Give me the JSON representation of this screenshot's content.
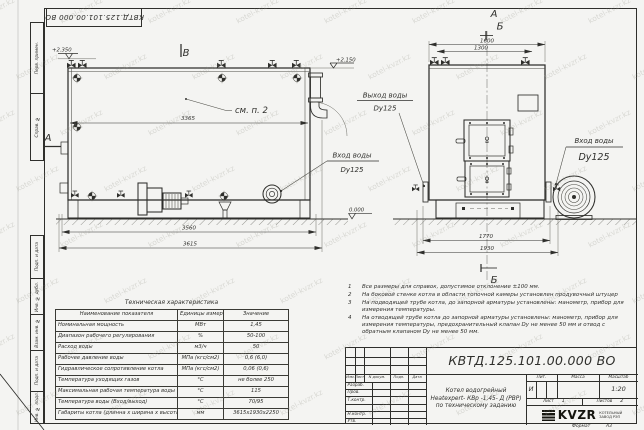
{
  "page": {
    "background": "#f4f4f2",
    "ink": "#2f2f2c",
    "watermark_text": "kotel-kvzr.kz"
  },
  "frame": {
    "margin_labels_top": [
      "Перв. примен.",
      "Справ. №"
    ],
    "margin_labels_bottom": [
      "Подп. и дата",
      "Инв. № дубл.",
      "Взам. инв. №",
      "Подп. и дата",
      "Инв. № подл."
    ],
    "format_label": "Формат",
    "format_value": "А3"
  },
  "drawing": {
    "view_labels": {
      "b": "В",
      "a": "А",
      "section_a": "А",
      "section_b": "Б",
      "section_b_bottom": "Б"
    },
    "annotations": {
      "see_item": "см. п. 2",
      "elev_top_left": "+2.350",
      "elev_top_right": "+2.150",
      "elev_zero": "0.000"
    },
    "dims": {
      "d3365": "3365",
      "d3560": "3560",
      "d3615": "3615",
      "d1600": "1600",
      "d1300": "1300",
      "d1770": "1770",
      "d1930": "1930"
    },
    "callouts": {
      "water_outlet": {
        "line1": "Выход воды",
        "line2": "Dy125"
      },
      "water_inlet_side": {
        "line1": "Вход воды",
        "line2": "Dy125"
      },
      "water_inlet_front": {
        "line1": "Вход воды",
        "line2": "Dy125"
      }
    }
  },
  "tech_table": {
    "title": "Техническая характеристика",
    "headers": [
      "Наименование показателя",
      "Единицы измерения",
      "Значение"
    ],
    "rows": [
      [
        "Номинальная мощность",
        "МВт",
        "1,45"
      ],
      [
        "Диапазон рабочего регулирования",
        "%",
        "50-100"
      ],
      [
        "Расход воды",
        "м3/ч",
        "50"
      ],
      [
        "Рабочее давление воды",
        "МПа (кгс/см2)",
        "0,6 (6,0)"
      ],
      [
        "Гидравлическое сопротивление котла",
        "МПа (кгс/см2)",
        "0,06 (0,6)"
      ],
      [
        "Температура уходящих газов",
        "°С",
        "не более 250"
      ],
      [
        "Максимальная рабочая температура воды",
        "°С",
        "115"
      ],
      [
        "Температура воды (Вход/выход)",
        "°С",
        "70/95"
      ],
      [
        "Габариты котла (длинна х ширина х высота)",
        "мм",
        "3615х1930х2250"
      ]
    ]
  },
  "notes": {
    "items": [
      {
        "num": "1",
        "text": "Все размеры для справок, допустимое отклонение ±100 мм."
      },
      {
        "num": "2",
        "text": "На боковой стенке котла в области топочной камеры установлен продувочный штуцер"
      },
      {
        "num": "3",
        "text": "На подводящей трубе котла, до запорной арматуры установлены: манометр, прибор для измерения температуры."
      },
      {
        "num": "4",
        "text": "На отводящей трубе котла до запорной арматуры установлены: манометр, прибор для измерения температуры, предохранительный клапан Dу не менее 50 мм и отвод с обратным клапаном Dу не менее 50 мм."
      }
    ]
  },
  "title_block": {
    "doc_number": "КВТД.125.101.00.000  ВО",
    "header_cols": [
      "Изм.",
      "Лист",
      "N докум.",
      "Подп.",
      "Дата"
    ],
    "row_labels": [
      "Разраб.",
      "Пров.",
      "Т.контр.",
      "Н.контр.",
      "Утв."
    ],
    "product_line1": "Котел водогрейный",
    "product_line2": "Heatexpert- КВр -1,45- Д (РВР)",
    "product_line3": "по техническому заданию",
    "lit_header": "Лит.",
    "mass_header": "Масса",
    "scale_header": "Масштаб",
    "lit_value": "И",
    "scale_value": "1:20",
    "sheet_label": "Лист",
    "sheet_value": "1",
    "sheets_label": "Листов",
    "sheets_value": "2",
    "logo_text": "KVZR",
    "company_line1": "КОТЕЛЬНЫЙ",
    "company_line2": "ЗАВОД РЭП"
  }
}
